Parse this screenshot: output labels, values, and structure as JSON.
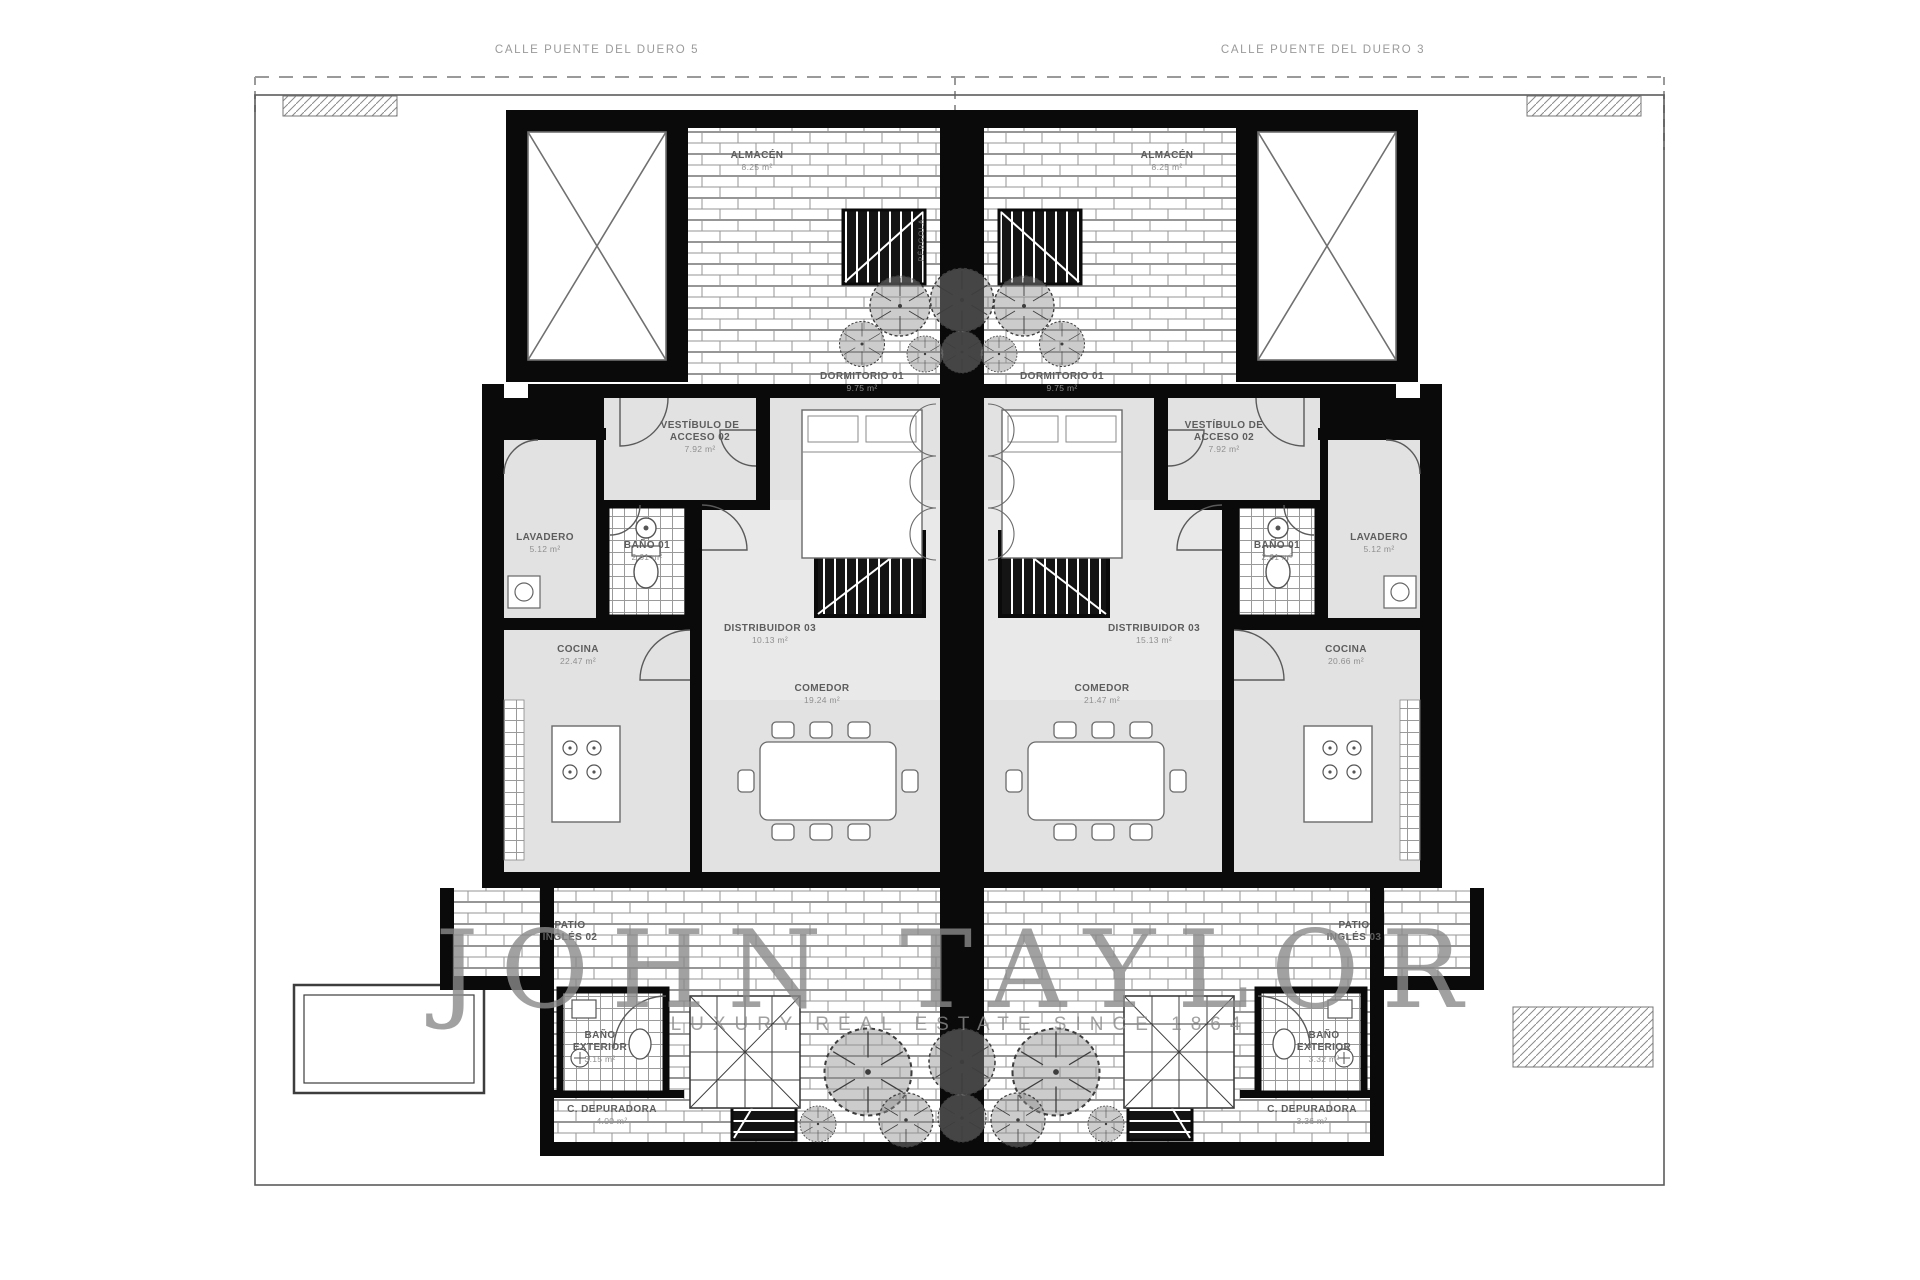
{
  "streets": {
    "left": "CALLE PUENTE DEL DUERO 5",
    "right": "CALLE PUENTE DEL DUERO 3"
  },
  "watermark": {
    "brand": "JOHN TAYLOR",
    "tagline": "LUXURY REAL ESTATE SINCE 1864"
  },
  "pergola_label": "PÉRGOLA",
  "units": {
    "left": {
      "rooms": {
        "almacen": {
          "name": "ALMACÉN",
          "area": "8.25 m²"
        },
        "dormitorio": {
          "name": "DORMITORIO 01",
          "area": "9.75 m²"
        },
        "vestibulo": {
          "name": "VESTÍBULO DE\nACCESO 02",
          "area": "7.92 m²"
        },
        "lavadero": {
          "name": "LAVADERO",
          "area": "5.12 m²"
        },
        "bano": {
          "name": "BAÑO 01",
          "area": "2.61 m²"
        },
        "cocina": {
          "name": "COCINA",
          "area": "22.47 m²"
        },
        "distribuidor": {
          "name": "DISTRIBUIDOR 03",
          "area": "10.13 m²"
        },
        "comedor": {
          "name": "COMEDOR",
          "area": "19.24 m²"
        },
        "patio": {
          "name": "PATIO\nINGLÉS 02"
        },
        "bano_exterior": {
          "name": "BAÑO\nEXTERIOR",
          "area": "3.15 m²"
        },
        "depuradora": {
          "name": "C. DEPURADORA",
          "area": "4.00 m²"
        }
      }
    },
    "right": {
      "rooms": {
        "almacen": {
          "name": "ALMACÉN",
          "area": "8.25 m²"
        },
        "dormitorio": {
          "name": "DORMITORIO 01",
          "area": "9.75 m²"
        },
        "vestibulo": {
          "name": "VESTÍBULO DE\nACCESO 02",
          "area": "7.92 m²"
        },
        "lavadero": {
          "name": "LAVADERO",
          "area": "5.12 m²"
        },
        "bano": {
          "name": "BAÑO 01",
          "area": "2.61 m²"
        },
        "cocina": {
          "name": "COCINA",
          "area": "20.66 m²"
        },
        "distribuidor": {
          "name": "DISTRIBUIDOR 03",
          "area": "15.13 m²"
        },
        "comedor": {
          "name": "COMEDOR",
          "area": "21.47 m²"
        },
        "patio": {
          "name": "PATIO\nINGLÉS 03"
        },
        "bano_exterior": {
          "name": "BAÑO\nEXTERIOR",
          "area": "3.32 m²"
        },
        "depuradora": {
          "name": "C. DEPURADORA",
          "area": "3.36 m²"
        }
      }
    }
  }
}
